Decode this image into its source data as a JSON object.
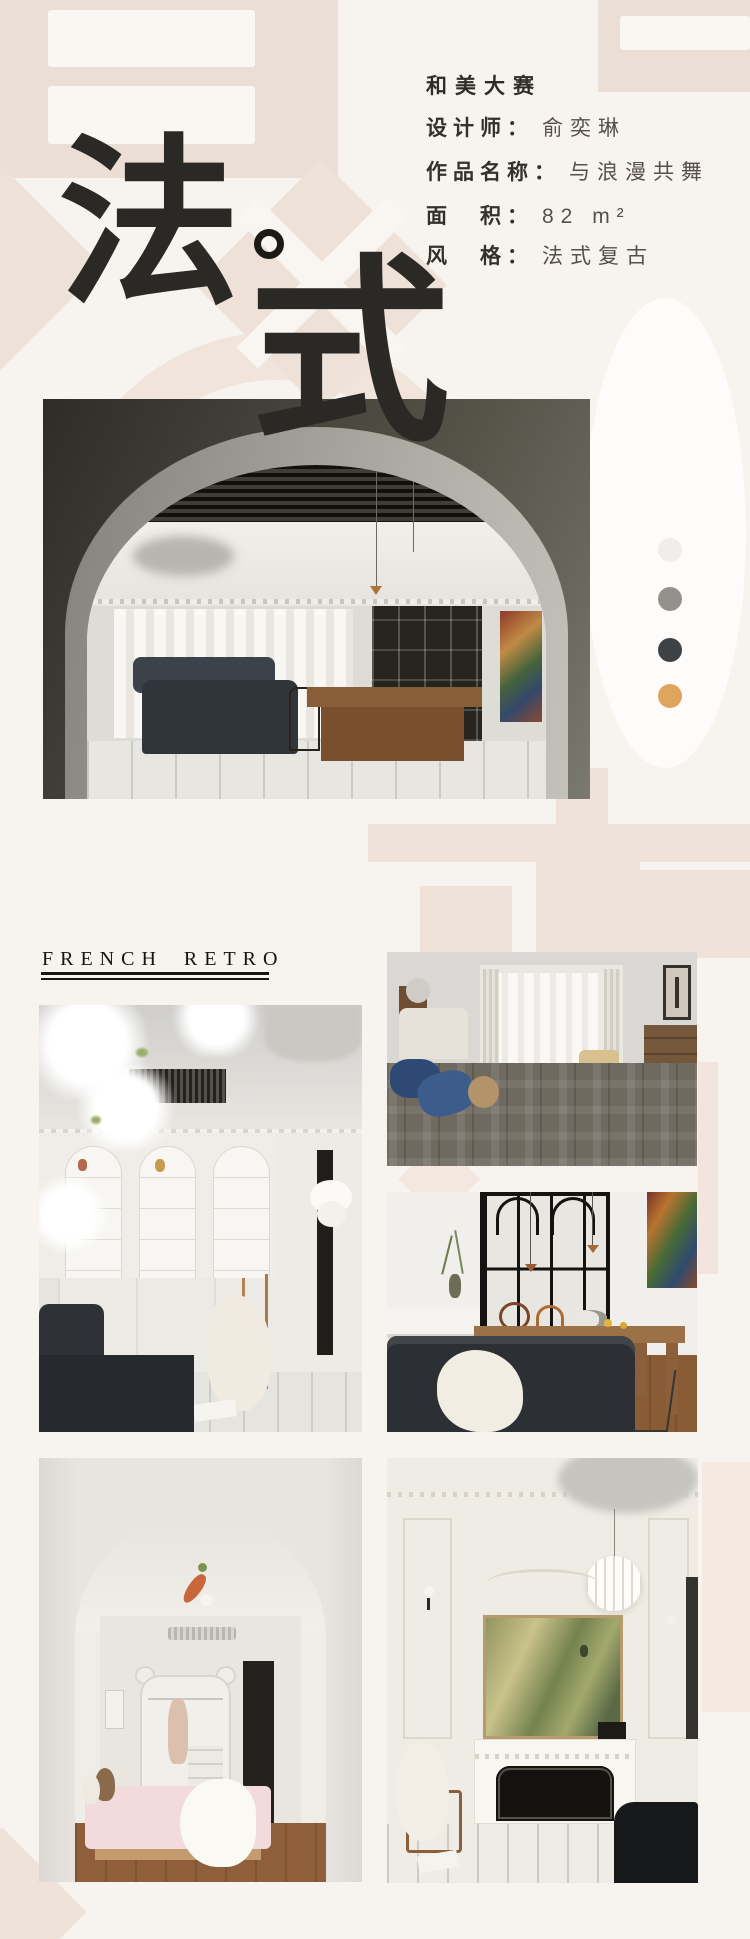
{
  "header": {
    "competition_title": "和美大赛",
    "fields": [
      {
        "label": "设计师：",
        "value": "俞奕琳"
      },
      {
        "label": "作品名称：",
        "value": "与浪漫共舞"
      },
      {
        "label": "面　积：",
        "value": "82 m²"
      },
      {
        "label": "风　格：",
        "value": "法式复古"
      }
    ]
  },
  "hero": {
    "char1": "法",
    "char2": "式"
  },
  "section": {
    "title": "FRENCH RETRO"
  },
  "palette": {
    "colors": [
      "#efeeec",
      "#94908c",
      "#3f4245",
      "#dfa55e"
    ]
  }
}
